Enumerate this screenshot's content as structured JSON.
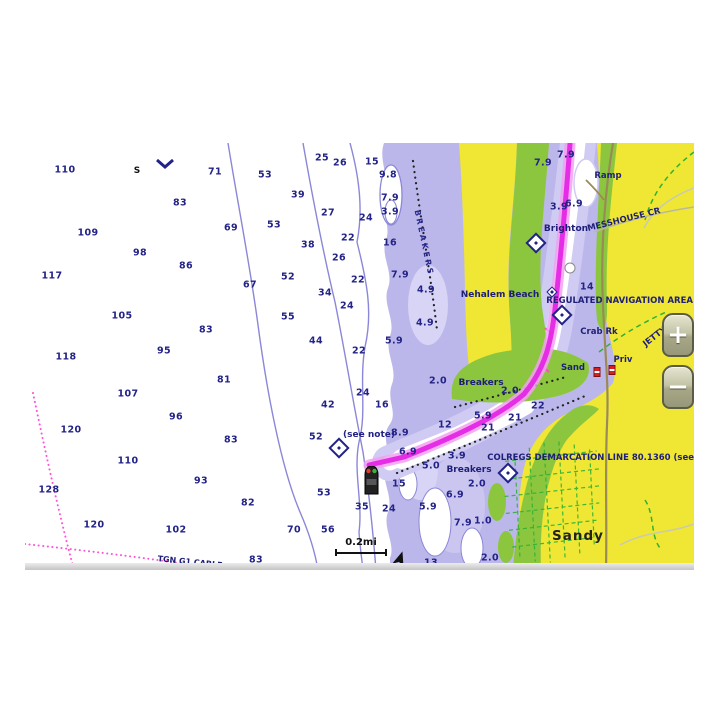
{
  "map": {
    "colors": {
      "land_yellow": "#efe733",
      "intertidal_green": "#8cc63e",
      "shallow_purple": "#bcb7ea",
      "shallow_light": "#d7d4f6",
      "contour_line": "#8b87d8",
      "sounding_text": "#232387",
      "route_magenta": "#e52de5",
      "route_glow": "#f2a0f2",
      "cable_pink": "#ff54d4",
      "road_brown": "#9a8a58",
      "street_green": "#2eb135"
    },
    "scale": {
      "label": "0.2mi"
    },
    "controls": {
      "zoom_in": "+",
      "zoom_out": "−"
    },
    "soundings": [
      {
        "t": "110",
        "x": 65,
        "y": 170
      },
      {
        "t": "71",
        "x": 215,
        "y": 172
      },
      {
        "t": "83",
        "x": 180,
        "y": 203
      },
      {
        "t": "109",
        "x": 88,
        "y": 233
      },
      {
        "t": "69",
        "x": 231,
        "y": 228
      },
      {
        "t": "98",
        "x": 140,
        "y": 253
      },
      {
        "t": "86",
        "x": 186,
        "y": 266
      },
      {
        "t": "117",
        "x": 52,
        "y": 276
      },
      {
        "t": "67",
        "x": 250,
        "y": 285
      },
      {
        "t": "105",
        "x": 122,
        "y": 316
      },
      {
        "t": "83",
        "x": 206,
        "y": 330
      },
      {
        "t": "118",
        "x": 66,
        "y": 357
      },
      {
        "t": "95",
        "x": 164,
        "y": 351
      },
      {
        "t": "81",
        "x": 224,
        "y": 380
      },
      {
        "t": "107",
        "x": 128,
        "y": 394
      },
      {
        "t": "96",
        "x": 176,
        "y": 417
      },
      {
        "t": "120",
        "x": 71,
        "y": 430
      },
      {
        "t": "83",
        "x": 231,
        "y": 440
      },
      {
        "t": "110",
        "x": 128,
        "y": 461
      },
      {
        "t": "93",
        "x": 201,
        "y": 481
      },
      {
        "t": "128",
        "x": 49,
        "y": 490
      },
      {
        "t": "82",
        "x": 248,
        "y": 503
      },
      {
        "t": "120",
        "x": 94,
        "y": 525
      },
      {
        "t": "102",
        "x": 176,
        "y": 530
      },
      {
        "t": "70",
        "x": 294,
        "y": 530
      },
      {
        "t": "83",
        "x": 256,
        "y": 560
      },
      {
        "t": "53",
        "x": 265,
        "y": 175
      },
      {
        "t": "39",
        "x": 298,
        "y": 195
      },
      {
        "t": "27",
        "x": 328,
        "y": 213
      },
      {
        "t": "53",
        "x": 274,
        "y": 225
      },
      {
        "t": "38",
        "x": 308,
        "y": 245
      },
      {
        "t": "52",
        "x": 288,
        "y": 277
      },
      {
        "t": "34",
        "x": 325,
        "y": 293
      },
      {
        "t": "55",
        "x": 288,
        "y": 317
      },
      {
        "t": "44",
        "x": 316,
        "y": 341
      },
      {
        "t": "52",
        "x": 316,
        "y": 437
      },
      {
        "t": "53",
        "x": 324,
        "y": 493
      },
      {
        "t": "35",
        "x": 362,
        "y": 507
      },
      {
        "t": "56",
        "x": 328,
        "y": 530
      },
      {
        "t": "25",
        "x": 322,
        "y": 158
      },
      {
        "t": "26",
        "x": 340,
        "y": 163
      },
      {
        "t": "15",
        "x": 372,
        "y": 162
      },
      {
        "t": "24",
        "x": 366,
        "y": 218
      },
      {
        "t": "22",
        "x": 348,
        "y": 238
      },
      {
        "t": "16",
        "x": 390,
        "y": 243
      },
      {
        "t": "26",
        "x": 339,
        "y": 258
      },
      {
        "t": "22",
        "x": 358,
        "y": 280
      },
      {
        "t": "24",
        "x": 347,
        "y": 306
      },
      {
        "t": "22",
        "x": 359,
        "y": 351
      },
      {
        "t": "24",
        "x": 363,
        "y": 393
      },
      {
        "t": "16",
        "x": 382,
        "y": 405
      },
      {
        "t": "42",
        "x": 328,
        "y": 405
      },
      {
        "t": "24",
        "x": 389,
        "y": 509
      },
      {
        "t": "13",
        "x": 431,
        "y": 563
      },
      {
        "t": "9.8",
        "x": 388,
        "y": 175
      },
      {
        "t": "7.9",
        "x": 390,
        "y": 198
      },
      {
        "t": "3.9",
        "x": 390,
        "y": 212
      },
      {
        "t": "7.9",
        "x": 400,
        "y": 275
      },
      {
        "t": "4.9",
        "x": 426,
        "y": 290
      },
      {
        "t": "4.9",
        "x": 425,
        "y": 323
      },
      {
        "t": "5.9",
        "x": 394,
        "y": 341
      },
      {
        "t": "8.9",
        "x": 400,
        "y": 433
      },
      {
        "t": "6.9",
        "x": 408,
        "y": 452
      },
      {
        "t": "3.9",
        "x": 457,
        "y": 456
      },
      {
        "t": "5.0",
        "x": 431,
        "y": 466
      },
      {
        "t": "2.0",
        "x": 477,
        "y": 484
      },
      {
        "t": "15",
        "x": 399,
        "y": 484
      },
      {
        "t": "6.9",
        "x": 455,
        "y": 495
      },
      {
        "t": "5.9",
        "x": 428,
        "y": 507
      },
      {
        "t": "7.9",
        "x": 463,
        "y": 523
      },
      {
        "t": "1.0",
        "x": 483,
        "y": 521
      },
      {
        "t": "2.0",
        "x": 490,
        "y": 558
      },
      {
        "t": "7.9",
        "x": 543,
        "y": 163
      },
      {
        "t": "7.9",
        "x": 566,
        "y": 155
      },
      {
        "t": "6.9",
        "x": 574,
        "y": 204
      },
      {
        "t": "3.9",
        "x": 559,
        "y": 207
      },
      {
        "t": "14",
        "x": 587,
        "y": 287
      },
      {
        "t": "2.0",
        "x": 438,
        "y": 381
      },
      {
        "t": "2.0",
        "x": 510,
        "y": 391
      },
      {
        "t": "22",
        "x": 538,
        "y": 406
      },
      {
        "t": "21",
        "x": 515,
        "y": 418
      },
      {
        "t": "21",
        "x": 488,
        "y": 428
      },
      {
        "t": "12",
        "x": 445,
        "y": 425
      },
      {
        "t": "5.9",
        "x": 483,
        "y": 416
      }
    ],
    "labels": [
      {
        "t": "S",
        "x": 137,
        "y": 171,
        "cls": "sym"
      },
      {
        "t": "Brighton",
        "x": 566,
        "y": 229
      },
      {
        "t": "MESSHOUSE CR",
        "x": 624,
        "y": 220,
        "rot": -14,
        "cls": "small"
      },
      {
        "t": "Ramp",
        "x": 608,
        "y": 176,
        "cls": "small"
      },
      {
        "t": "Nehalem Beach",
        "x": 500,
        "y": 295
      },
      {
        "t": "REGULATED NAVIGATION AREA",
        "x": 693,
        "y": 301,
        "cls": "small",
        "anchor": "right"
      },
      {
        "t": "Crab Rk",
        "x": 599,
        "y": 332,
        "cls": "small"
      },
      {
        "t": "Priv",
        "x": 623,
        "y": 360,
        "cls": "small"
      },
      {
        "t": "Sand",
        "x": 573,
        "y": 368,
        "cls": "small"
      },
      {
        "t": "Breakers",
        "x": 481,
        "y": 383
      },
      {
        "t": "Breakers",
        "x": 469,
        "y": 470
      },
      {
        "t": "(see note)",
        "x": 369,
        "y": 435,
        "cls": "note"
      },
      {
        "t": "JETTY",
        "x": 655,
        "y": 337,
        "rot": -38,
        "cls": "small"
      },
      {
        "t": "COLREGS DEMARCATION LINE 80.1360 (see",
        "x": 694,
        "y": 458,
        "cls": "small",
        "anchor": "right"
      },
      {
        "t": "Sandy",
        "x": 578,
        "y": 536,
        "cls": "big"
      },
      {
        "t": "TGN G1 CABLE",
        "x": 190,
        "y": 562,
        "rot": 6,
        "cls": "cable"
      },
      {
        "t": "BREAKERS",
        "x": 424,
        "y": 243,
        "rot": 78,
        "cls": "vert"
      }
    ],
    "markers": [
      {
        "x": 339,
        "y": 448
      },
      {
        "x": 536,
        "y": 243
      },
      {
        "x": 562,
        "y": 315
      },
      {
        "x": 508,
        "y": 473
      },
      {
        "x": 552,
        "y": 292,
        "cls": "sm"
      }
    ],
    "beacons": [
      {
        "x": 597,
        "y": 372
      },
      {
        "x": 612,
        "y": 370
      }
    ],
    "boat": [
      {
        "x": 363,
        "y": 466
      }
    ],
    "chevron": [
      {
        "x": 155,
        "y": 158
      }
    ],
    "north_arrow": [
      {
        "x": 393,
        "y": 551
      }
    ],
    "route_point": [
      {
        "x": 570,
        "y": 268
      }
    ]
  }
}
